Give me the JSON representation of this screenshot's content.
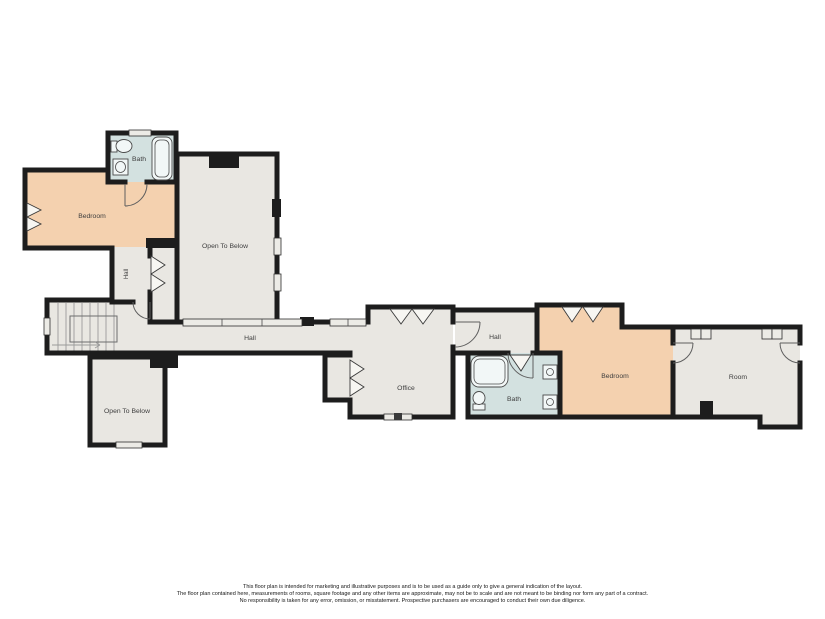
{
  "colors": {
    "wall": "#1d1d1d",
    "floor_gray": "#e9e7e2",
    "floor_orange": "#f4d1af",
    "floor_blue": "#d3e1e0",
    "background": "#ffffff",
    "label_text": "#3d3d3d"
  },
  "rooms": [
    {
      "id": "bath-upper",
      "label": "Bath"
    },
    {
      "id": "bedroom-upper",
      "label": "Bedroom"
    },
    {
      "id": "open-to-below-main",
      "label": "Open To Below"
    },
    {
      "id": "hall-small",
      "label": "Hall"
    },
    {
      "id": "hall-main",
      "label": "Hall"
    },
    {
      "id": "open-to-below-lower",
      "label": "Open To Below"
    },
    {
      "id": "office",
      "label": "Office"
    },
    {
      "id": "hall-east",
      "label": "Hall"
    },
    {
      "id": "bath-lower",
      "label": "Bath"
    },
    {
      "id": "bedroom-east",
      "label": "Bedroom"
    },
    {
      "id": "room-east",
      "label": "Room"
    }
  ],
  "disclaimer": {
    "line1": "This floor plan is intended for marketing and illustrative purposes and is to be used as a guide only to give a general indication of the layout.",
    "line2": "The floor plan contained here, measurements of rooms, square footage and any other items are approximate, may not be to scale and are not meant to be binding nor form any part of a contract.",
    "line3": "No responsibility is taken for any error, omission, or misstatement. Prospective purchasers are encouraged to conduct their own due diligence."
  }
}
